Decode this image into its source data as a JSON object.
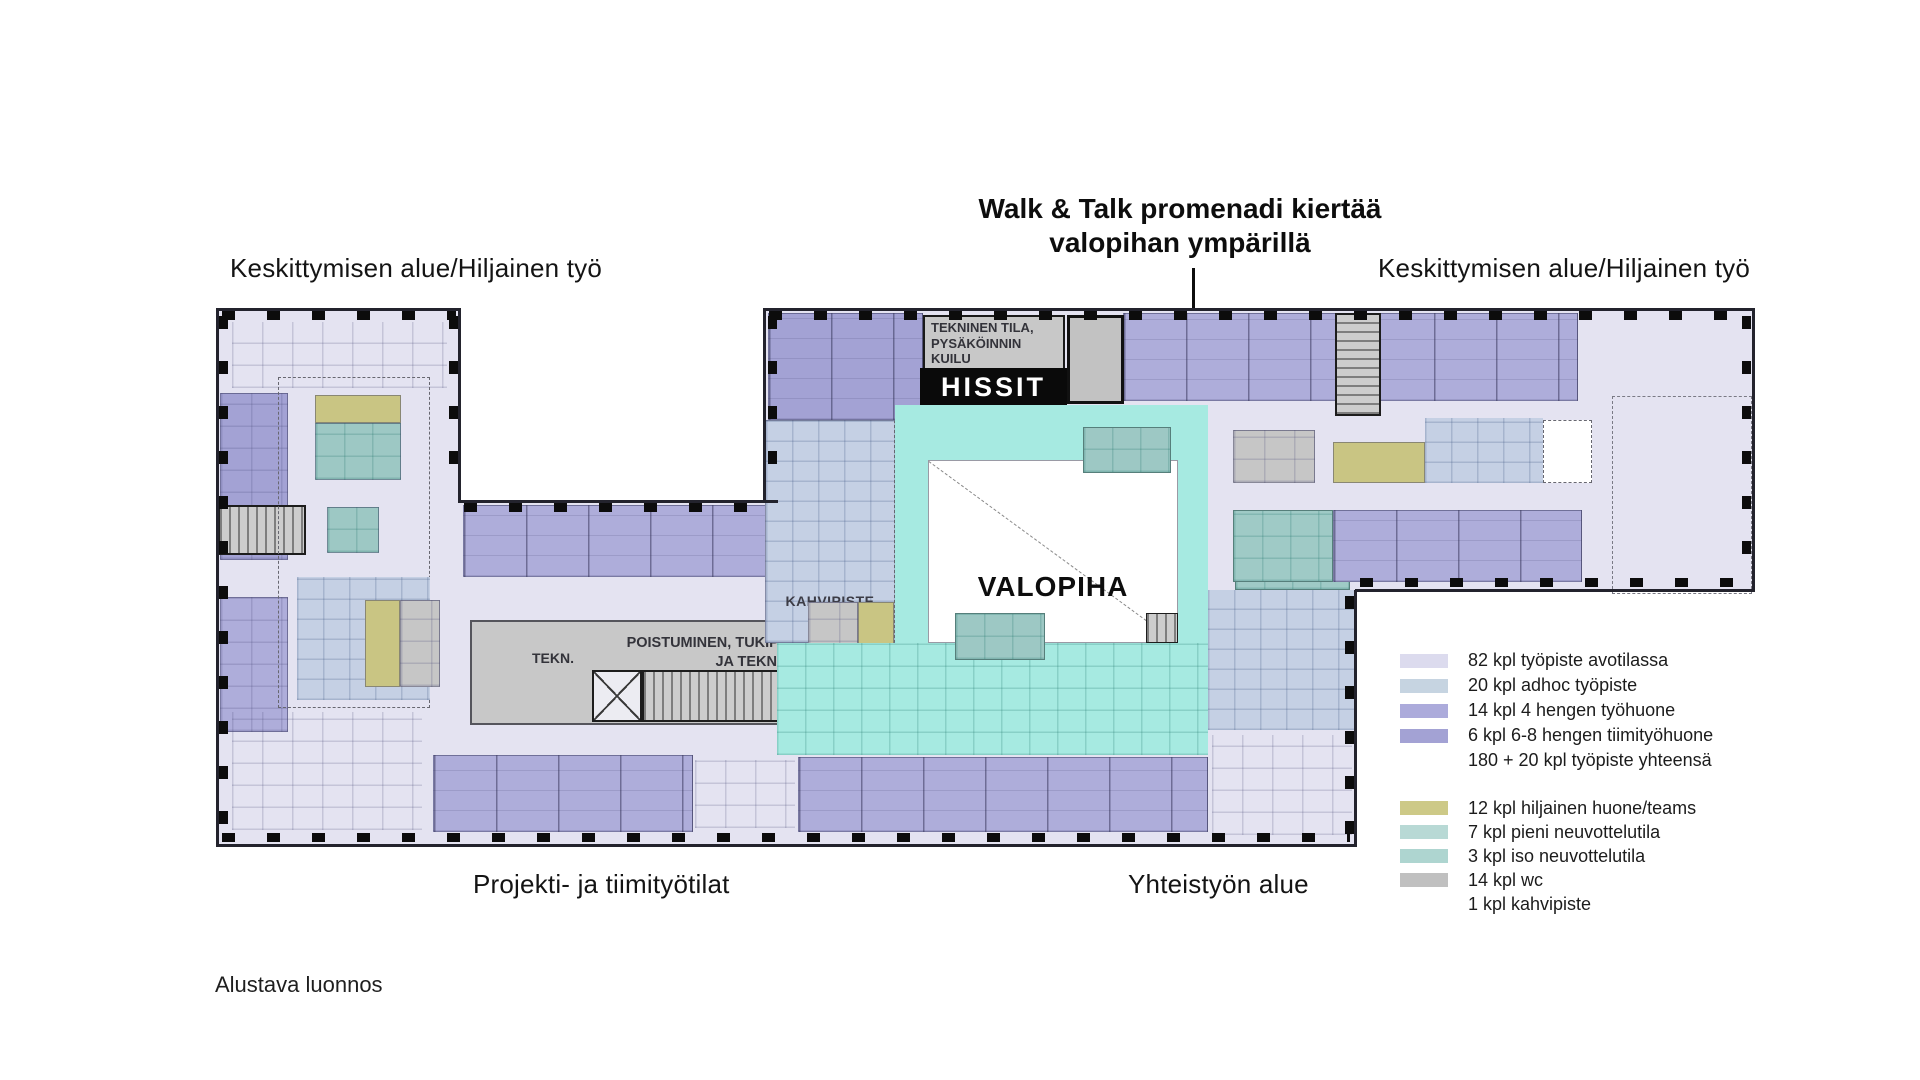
{
  "annotations": {
    "walk_talk": {
      "line1": "Walk & Talk promenadi kiertää",
      "line2": "valopihan ympärillä"
    },
    "area_top_left": "Keskittymisen alue/Hiljainen työ",
    "area_top_right": "Keskittymisen alue/Hiljainen työ",
    "area_bottom_left": "Projekti- ja tiimityötilat",
    "area_bottom_right": "Yhteistyön alue",
    "draft_note": "Alustava luonnos"
  },
  "plan": {
    "tekninen": {
      "line1": "TEKNINEN TILA,",
      "line2": "PYSÄKÖINNIN",
      "line3": "KUILU"
    },
    "hissit": "HISSIT",
    "valopiha": "VALOPIHA",
    "kahvipiste": "KAHVIPISTE",
    "tekn": "TEKN.",
    "poistuminen": {
      "line1": "POISTUMINEN, TUKIP.",
      "line2": "JA TEKN."
    }
  },
  "legend": {
    "workspace_group": [
      {
        "swatch": "#dcdbee",
        "label": "82 kpl työpiste avotilassa"
      },
      {
        "swatch": "#c6d4e1",
        "label": "20 kpl adhoc työpiste"
      },
      {
        "swatch": "#acabdb",
        "label": "14 kpl 4 hengen työhuone"
      },
      {
        "swatch": "#a3a2d4",
        "label": "6 kpl 6-8 hengen tiimityöhuone"
      },
      {
        "swatch": "",
        "label": "180 + 20 kpl työpiste yhteensä"
      }
    ],
    "room_group": [
      {
        "swatch": "#cdc987",
        "label": "12 kpl hiljainen huone/teams"
      },
      {
        "swatch": "#b8d9d5",
        "label": "7 kpl pieni neuvottelutila"
      },
      {
        "swatch": "#aed5d0",
        "label": "3 kpl iso neuvottelutila"
      },
      {
        "swatch": "#c0c0c0",
        "label": "14 kpl wc"
      },
      {
        "swatch": "",
        "label": "1 kpl kahvipiste"
      }
    ]
  },
  "colors": {
    "open": "#e4e3f1",
    "adhoc": "#c5d0e4",
    "room4": "#aeadda",
    "roomTeam": "#a3a2d4",
    "quiet": "#c9c583",
    "meetSmall": "#9dc8c4",
    "meetLarge": "#9fcac6",
    "wc": "#c6c6c6",
    "promenade": "#a6eae1",
    "grayBox": "#c8c8c8",
    "hissitBg": "#0a0a0a"
  }
}
